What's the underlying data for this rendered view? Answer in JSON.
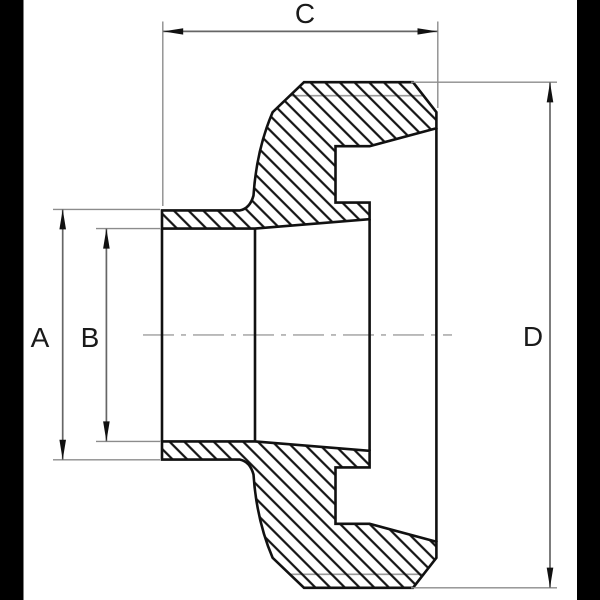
{
  "diagram": {
    "type": "technical-section-drawing",
    "subject": "pipe fitting cross-section with hatched cut faces",
    "dimension_labels": [
      "A",
      "B",
      "C",
      "D"
    ]
  },
  "dimensions": {
    "a": {
      "label": "A"
    },
    "b": {
      "label": "B"
    },
    "c": {
      "label": "C"
    },
    "d": {
      "label": "D"
    }
  },
  "colors": {
    "background": "#ffffff",
    "letterbox_bars": "#000000",
    "part_outline": "#111111",
    "hatch_lines": "#111111",
    "dimension_line": "#666666",
    "extension_line": "#8c8c8c",
    "thin_feature_line": "#9a9a9a",
    "centerline": "#b8b8b8",
    "arrowhead": "#111111",
    "label_text": "#1a1a1a"
  }
}
